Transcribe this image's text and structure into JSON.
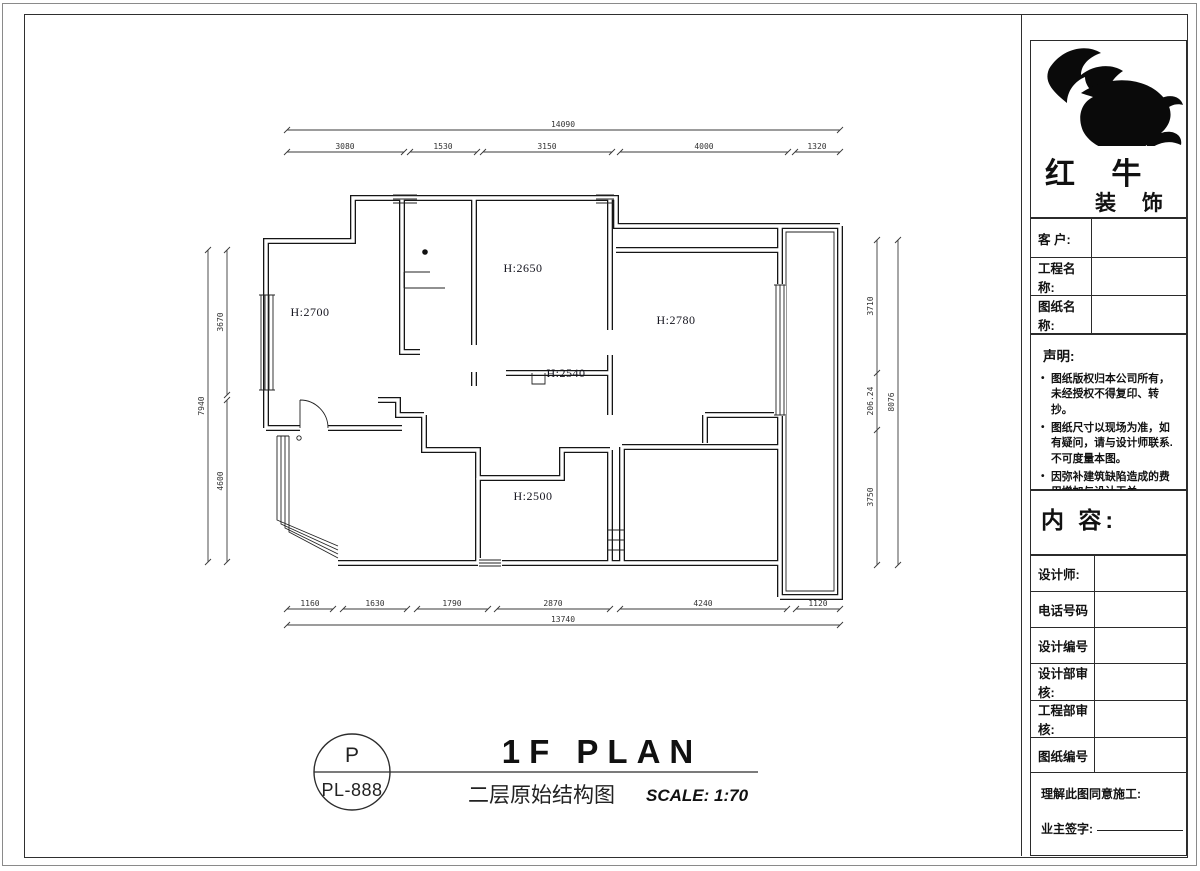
{
  "company": {
    "name_main": "红 牛",
    "name_sub": "装 饰"
  },
  "sidebar": {
    "info_rows": [
      {
        "label": "客  户:"
      },
      {
        "label": "工程名称:"
      },
      {
        "label": "图纸名称:"
      }
    ],
    "statement": {
      "title": "声明:",
      "items": [
        "图纸版权归本公司所有，未经授权不得复印、转抄。",
        "图纸尺寸以现场为准，如有疑问，请与设计师联系. 不可度量本图。",
        "因弥补建筑缺陷造成的费用增加与设计无关。"
      ]
    },
    "content_label": "内 容:",
    "detail_rows": [
      {
        "label": "设计师:"
      },
      {
        "label": "电话号码"
      },
      {
        "label": "设计编号"
      },
      {
        "label": "设计部审核:"
      },
      {
        "label": "工程部审核:"
      },
      {
        "label": "图纸编号"
      }
    ],
    "sign": {
      "line1": "理解此图同意施工:",
      "line2": "业主签字:"
    }
  },
  "plan": {
    "rooms": [
      {
        "label": "H:2700"
      },
      {
        "label": "H:2650"
      },
      {
        "label": "H:2780"
      },
      {
        "label": "H:2540"
      },
      {
        "label": "H:2500"
      }
    ],
    "dims": {
      "top_total": "14090",
      "top_segments": [
        "3080",
        "1530",
        "3150",
        "4000",
        "1320"
      ],
      "bottom_total": "13740",
      "bottom_segments": [
        "1160",
        "1630",
        "1790",
        "2870",
        "4240",
        "1120"
      ],
      "left_total": "7940",
      "left_segments": [
        "3670",
        "4600"
      ],
      "right_total": "8076",
      "right_segments": [
        "3710",
        "206.24",
        "3750"
      ]
    }
  },
  "title_block": {
    "bubble_top": "P",
    "bubble_bottom": "PL-888",
    "title": "1F PLAN",
    "subtitle_cn": "二层原始结构图",
    "scale": "SCALE: 1:70"
  }
}
